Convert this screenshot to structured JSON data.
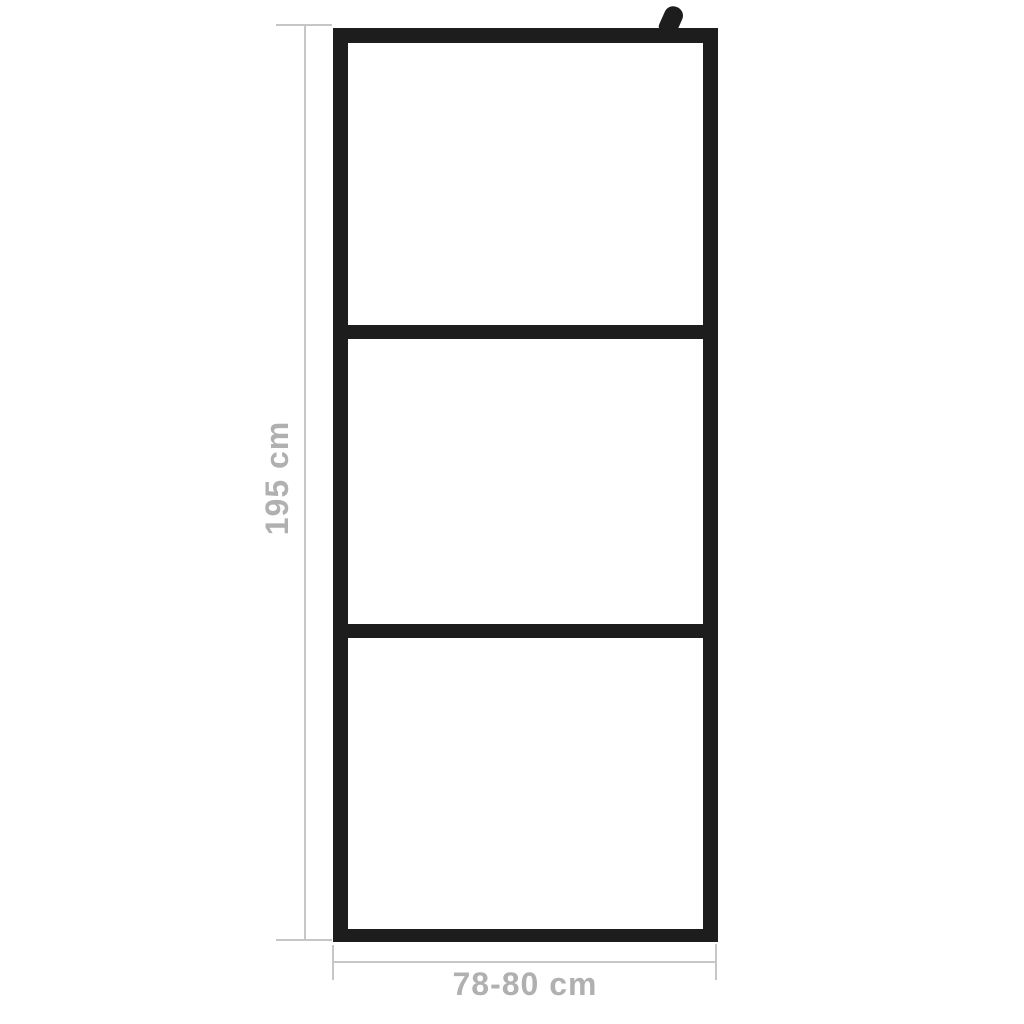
{
  "diagram": {
    "type": "product-dimension-diagram",
    "subject": "walk-in shower screen with 3-panel black frame",
    "panel_count": 3,
    "height_dimension": {
      "label": "195 cm",
      "orientation": "vertical"
    },
    "width_dimension": {
      "label": "78-80 cm",
      "orientation": "horizontal"
    },
    "icons": {
      "wall_mount_bracket": "wall-mount-bracket-icon"
    },
    "colors": {
      "background": "#ffffff",
      "frame": "#1d1d1d",
      "dimension_line": "#c6c6c6",
      "label_text": "#b0b0b0"
    }
  }
}
